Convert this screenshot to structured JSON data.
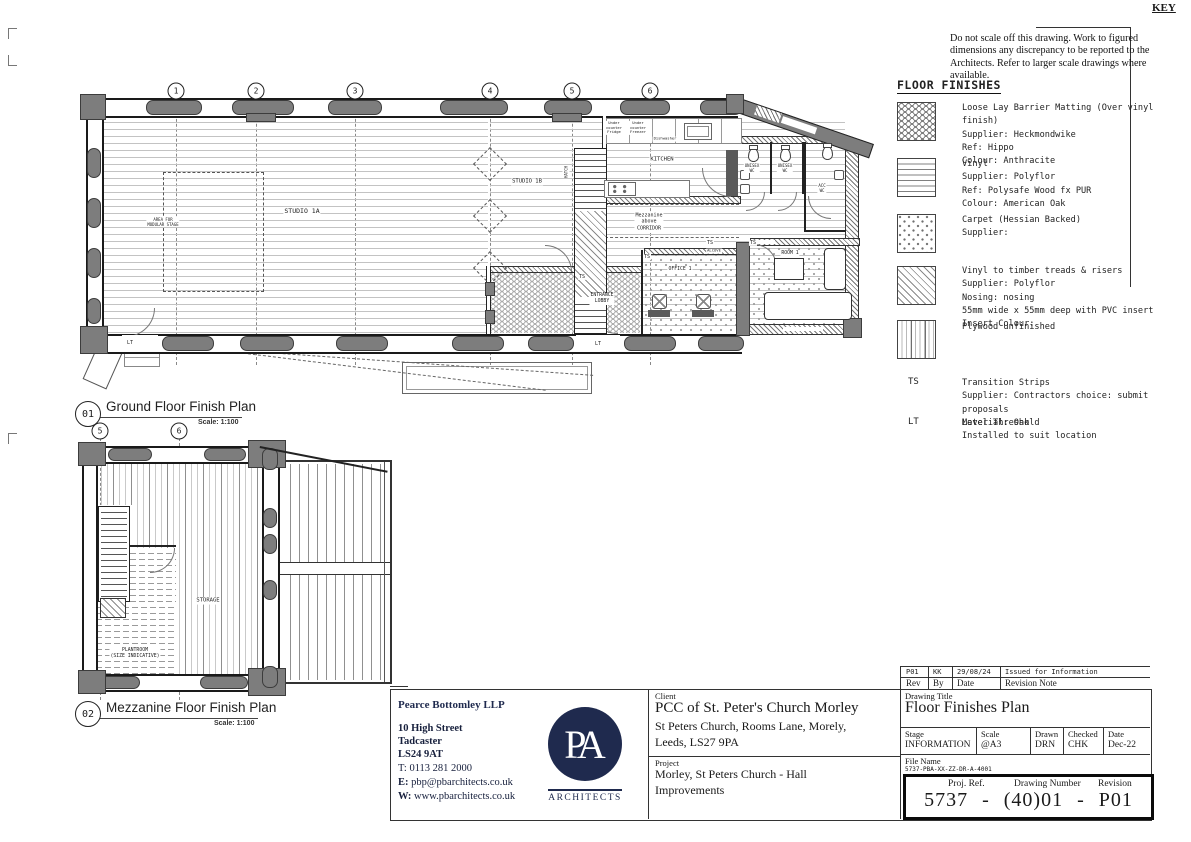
{
  "colors": {
    "navy": "#1f2a4e",
    "wall_gray": "#7d7d7d",
    "ink": "#1a1a1a"
  },
  "key": {
    "heading": "KEY",
    "disclaimer": "Do not scale off this drawing. Work to figured dimensions any discrepancy to be reported to the Architects. Refer to larger scale drawings where available."
  },
  "legend": {
    "heading": "FLOOR FINISHES",
    "items": [
      {
        "id": "matting",
        "text": "Loose Lay Barrier Matting (Over vinyl finish)\nSupplier: Heckmondwike\nRef: Hippo\nColour: Anthracite"
      },
      {
        "id": "vinyl",
        "text": "Vinyl\nSupplier: Polyflor\nRef: Polysafe Wood fx PUR\nColour: American Oak"
      },
      {
        "id": "carpet",
        "text": "Carpet (Hessian Backed)\nSupplier:"
      },
      {
        "id": "treads",
        "text": "Vinyl to timber treads & risers\nSupplier: Polyflor\nNosing: nosing\n55mm wide x 55mm deep with PVC insert\nInsert Colour:"
      },
      {
        "id": "plywood",
        "text": "Plywood unfinished"
      },
      {
        "id": "ts",
        "abbr": "TS",
        "text": "Transition Strips\nSupplier: Contractors choice: submit proposals\nMaterial: Oak"
      },
      {
        "id": "lt",
        "abbr": "LT",
        "text": "Level Threshold\nInstalled to suit location"
      }
    ]
  },
  "plans": {
    "ground": {
      "number": "01",
      "title": "Ground Floor Finish Plan",
      "scale": "Scale: 1:100",
      "grid": [
        "1",
        "2",
        "3",
        "4",
        "5",
        "6"
      ],
      "labels": {
        "studio1a": "STUDIO 1A",
        "studio1b": "STUDIO 1B",
        "kitchen": "KITCHEN",
        "stage": "AREA FOR\nMODULAR STAGE",
        "mezz": "Mezzanine\nabove\nCORRIDOR",
        "lobby": "ENTRANCE\nLOBBY",
        "office": "OFFICE 1",
        "room1": "ROOM 1",
        "wc1": "UNISEX\nWC",
        "wc2": "UNISEX\nWC",
        "accwc": "ACC\nWC",
        "alcove": "ALCOVE",
        "fridge": "Under\ncounter\nFridge",
        "freezer": "Under\ncounter\nFreezer",
        "dishwasher": "Dishwasher",
        "hatch": "HATCH",
        "ts": "TS",
        "lt": "LT"
      }
    },
    "mezzanine": {
      "number": "02",
      "title": "Mezzanine Floor Finish Plan",
      "scale": "Scale: 1:100",
      "grid": [
        "5",
        "6"
      ],
      "labels": {
        "storage": "STORAGE",
        "plantroom": "PLANTROOM\n(SIZE INDICATIVE)"
      }
    }
  },
  "title_block": {
    "architect": {
      "name": "Pearce Bottomley LLP",
      "address": "10 High Street\nTadcaster\nLS24 9AT",
      "phone_label": "T:",
      "phone": "0113 281 2000",
      "email_label": "E:",
      "email": "pbp@pbarchitects.co.uk",
      "web_label": "W:",
      "web": "www.pbarchitects.co.uk"
    },
    "logo": {
      "monogram": "PA",
      "caption": "ARCHITECTS"
    },
    "client_label": "Client",
    "client_name": "PCC of St. Peter's Church Morley",
    "client_address": "St Peters Church, Rooms Lane, Morely,\nLeeds, LS27 9PA",
    "project_label": "Project",
    "project_name": "Morley, St Peters Church - Hall\nImprovements",
    "revisions": {
      "row": [
        "P01",
        "KK",
        "29/08/24",
        "Issued for Information"
      ],
      "header": [
        "Rev",
        "By",
        "Date",
        "Revision Note"
      ]
    },
    "drawing_title_label": "Drawing Title",
    "drawing_title": "Floor Finishes Plan",
    "meta": {
      "stage_label": "Stage",
      "stage": "INFORMATION",
      "scale_label": "Scale",
      "scale": "@A3",
      "drawn_label": "Drawn",
      "drawn": "DRN",
      "checked_label": "Checked",
      "checked": "CHK",
      "date_label": "Date",
      "date": "Dec-22"
    },
    "file_label": "File Name",
    "file_name": "5737-PBA-XX-ZZ-DR-A-4001",
    "ref_box": {
      "proj_ref_label": "Proj. Ref.",
      "drawing_number_label": "Drawing Number",
      "revision_label": "Revision",
      "proj_ref": "5737",
      "sep": "-",
      "drawing_number": "(40)01",
      "revision": "P01"
    },
    "copyright": "Copyright Pearce Bottomley LLP"
  }
}
